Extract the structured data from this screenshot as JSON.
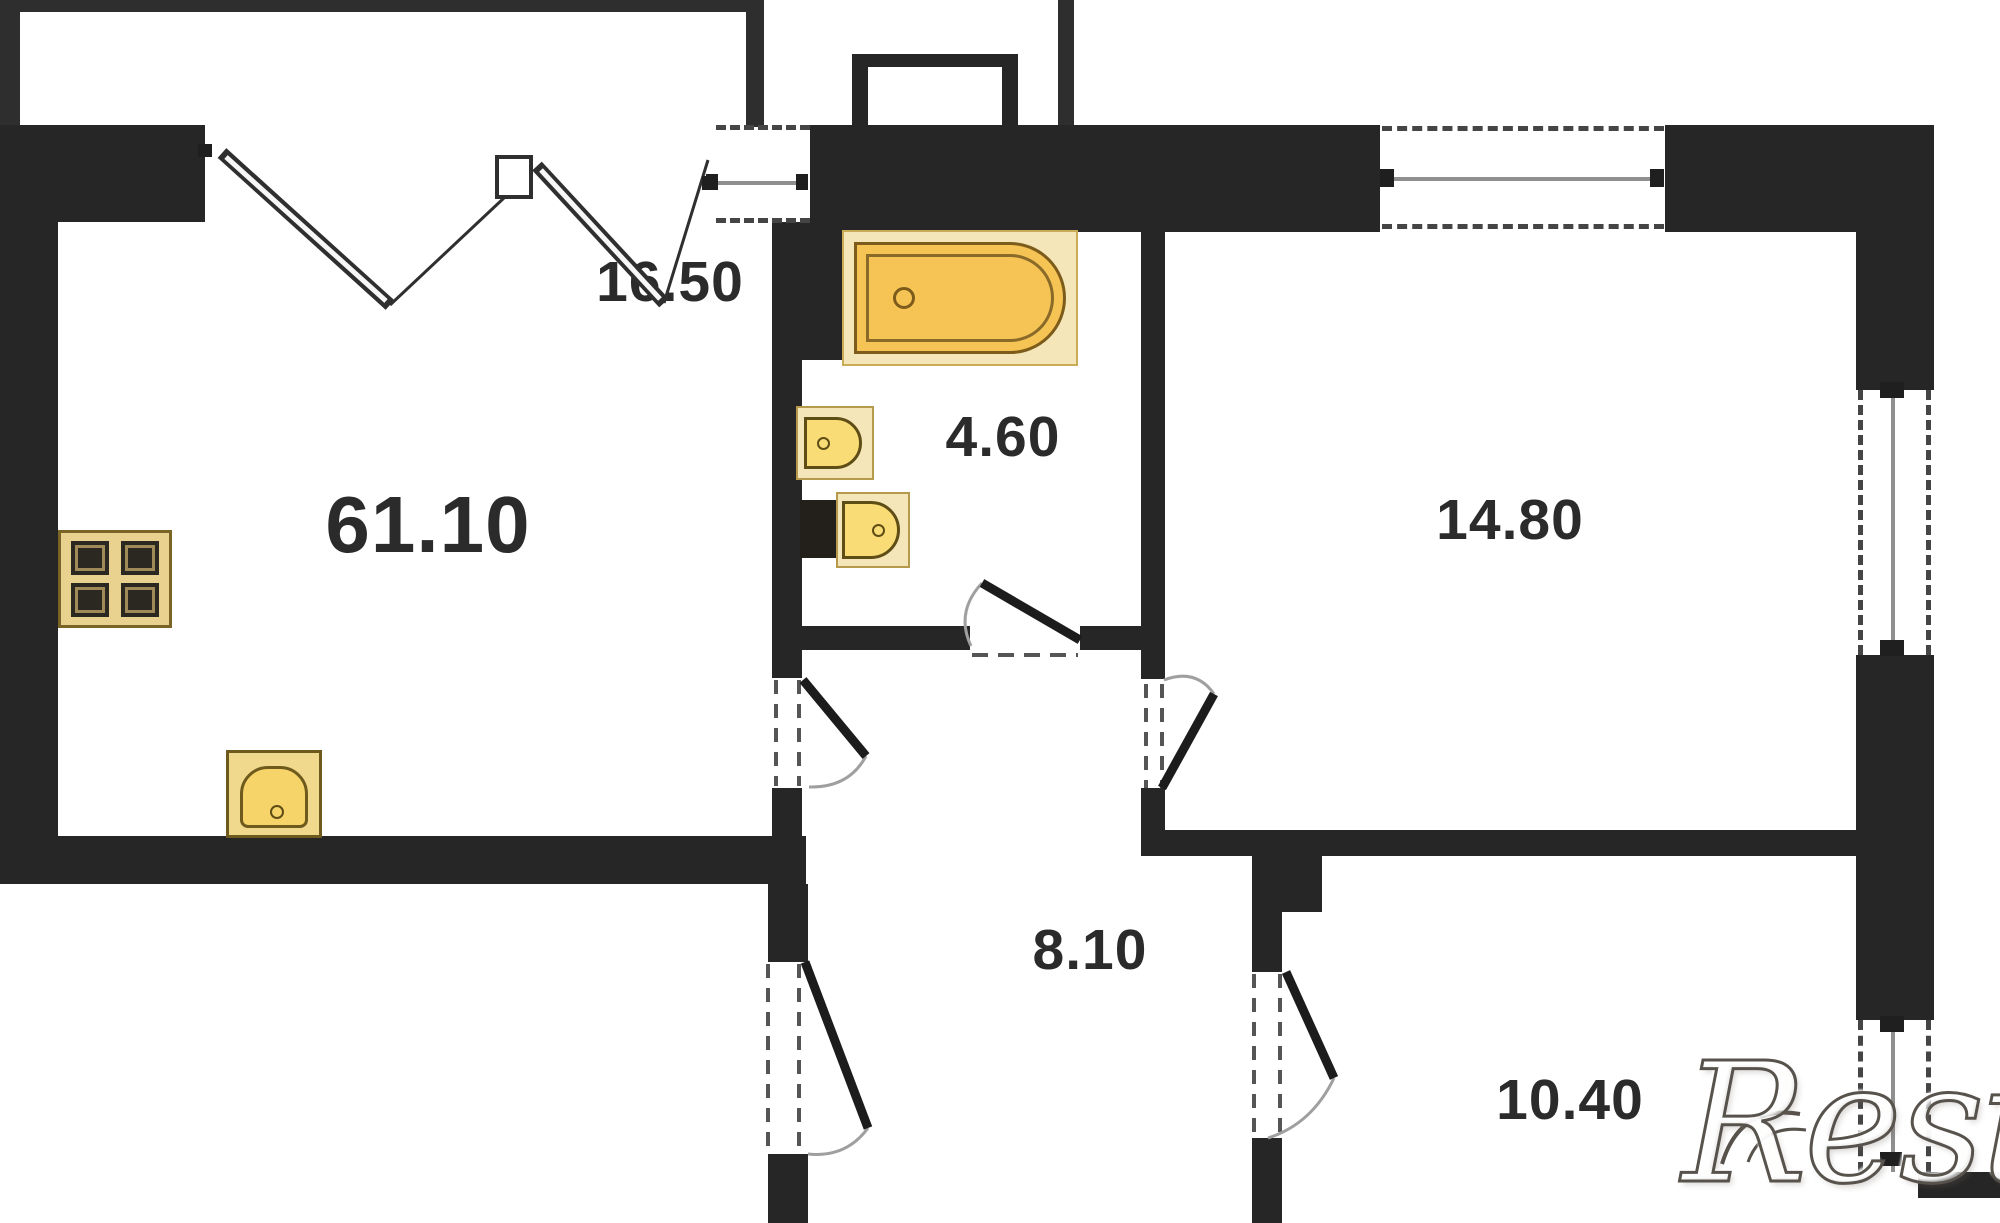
{
  "plan": {
    "watermark": "Restate",
    "rooms": {
      "total_area": "61.10",
      "living_room": "16.50",
      "bathroom": "4.60",
      "bedroom": "14.80",
      "hallway": "8.10",
      "kids_room": "10.40"
    },
    "icons": {
      "bathtub": "bathtub-icon",
      "wash_basin": "wash-basin-icon",
      "toilet": "toilet-icon",
      "stove": "stove-icon",
      "kitchen_sink": "kitchen-sink-icon",
      "folding_door": "folding-door-icon",
      "swing_door": "swing-door-icon"
    },
    "colors": {
      "wall": "#262626",
      "fixture_fill": "#f6c355",
      "fixture_fill_light": "#f9dc75",
      "fixture_backdrop": "#f4e6b8",
      "fixture_outline": "#6b5419",
      "label_text": "#2b2b2b",
      "watermark_outline": "#57524b"
    }
  }
}
